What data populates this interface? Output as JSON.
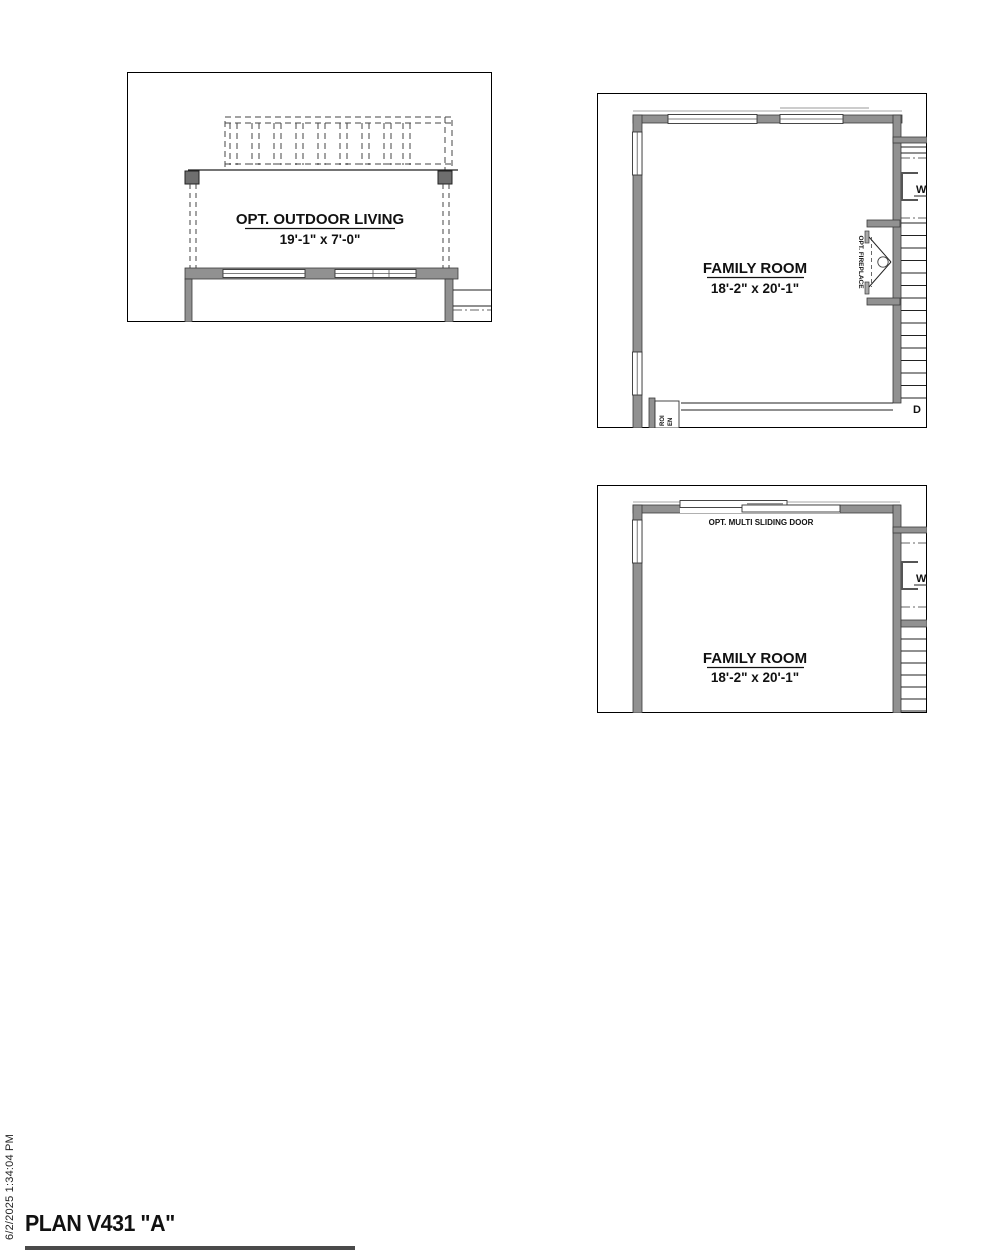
{
  "page": {
    "title": "PLAN V431 \"A\"",
    "timestamp": "6/2/2025 1:34:04 PM"
  },
  "panel_outdoor_living": {
    "name": "OPT. OUTDOOR LIVING",
    "dims": "19'-1\" x 7'-0\""
  },
  "panel_family_fireplace": {
    "name": "FAMILY ROOM",
    "dims": "18'-2\" x 20'-1\"",
    "fireplace_label": "OPT. FIREPLACE",
    "washer_label": "W",
    "dryer_label": "D",
    "corner_label_line1": "ROI",
    "corner_label_line2": "EN"
  },
  "panel_family_sliding": {
    "name": "FAMILY ROOM",
    "dims": "18'-2\" x 20'-1\"",
    "door_label": "OPT. MULTI SLIDING DOOR",
    "washer_label": "W"
  }
}
